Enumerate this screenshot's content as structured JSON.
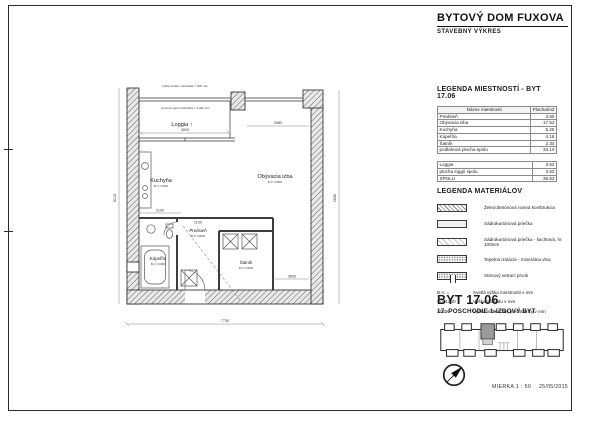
{
  "title_block": {
    "title": "BYTOVÝ DOM FUXOVA",
    "subtitle": "STAVEBNÝ VÝKRES"
  },
  "rooms_legend": {
    "heading": "LEGENDA MIESTNOSTÍ - BYT 17.06",
    "columns": {
      "name": "Názov miestnosti",
      "area": "Plocha/m2"
    },
    "rows": [
      {
        "name": "Predsieň",
        "area": "3.80"
      },
      {
        "name": "Obývacia izba",
        "area": "17.52"
      },
      {
        "name": "Kuchyňa",
        "area": "5.26"
      },
      {
        "name": "Kúpeľňa",
        "area": "4.18"
      },
      {
        "name": "Šatník",
        "area": "2.34"
      }
    ],
    "subtotal": {
      "name": "podlahová plocha spolu",
      "area": "33.10"
    },
    "loggia_row": {
      "name": "Loggia",
      "area": "3.52"
    },
    "loggia_subtotal": {
      "name": "plocha loggií spolu",
      "area": "3.52"
    },
    "total": {
      "name": "SPOLU",
      "area": "36.62"
    }
  },
  "materials_legend": {
    "heading": "LEGENDA MATERIÁLOV",
    "items": [
      {
        "swatch": "reinforced-concrete-hatch",
        "label": "Železobetónová nosná konštrukcia"
      },
      {
        "swatch": "plasterboard-partition",
        "label": "Sádrokartónová priečka"
      },
      {
        "swatch": "plasterboard-shaft-partition",
        "label": "Sádrokartónová priečka - šachtová, hr. 100mm"
      },
      {
        "swatch": "thermal-insulation-dots",
        "label": "Tepelná izolácia - minerálna vlna"
      },
      {
        "swatch": "wall-vent-element",
        "label": "Stenový vetrací prvok"
      }
    ],
    "abbreviations": [
      {
        "abbr": "B.V. =",
        "label": "Svetlá výška miestnosti v mm"
      },
      {
        "abbr": "v.o. 1200",
        "label": "Výška obkladu v mm"
      },
      {
        "abbr": "+1200",
        "label": "Výška inštalačnej predstienky v mm"
      }
    ]
  },
  "unit_block": {
    "unit": "BYT 17.06",
    "floor": "17. POSCHODIE 1-IZBOVÝ BYT"
  },
  "footer": {
    "scale": "MIERKA 1 : 50",
    "date": "25/05/2015"
  },
  "plan": {
    "rooms": {
      "loggia": {
        "label": "Loggia ↑"
      },
      "kuchyna": {
        "label": "Kuchyňa",
        "bv": "B.V.=2600"
      },
      "obyvacia": {
        "label": "Obývacia izba",
        "bv": "B.V.=2600"
      },
      "predsien": {
        "label": "Predsieň",
        "bv": "B.V.=2600"
      },
      "kupelna": {
        "label": "Kúpeľňa",
        "bv": "B.V.=2400"
      },
      "satnik": {
        "label": "Šatník",
        "bv": "B.V.=2600"
      }
    },
    "notes": {
      "railing_solid": "výška plného zábradlia = 900 mm",
      "railing_infill": "oceľová výplň zábradlia = 1100 mm"
    },
    "dims": {
      "loggia_w": "3000",
      "living_w": "2980",
      "kitchen_w": "2100",
      "hall_w": "1100",
      "living_inner": "3600",
      "right_h": "2630",
      "total_w": "7730",
      "total_h": "5210"
    }
  }
}
